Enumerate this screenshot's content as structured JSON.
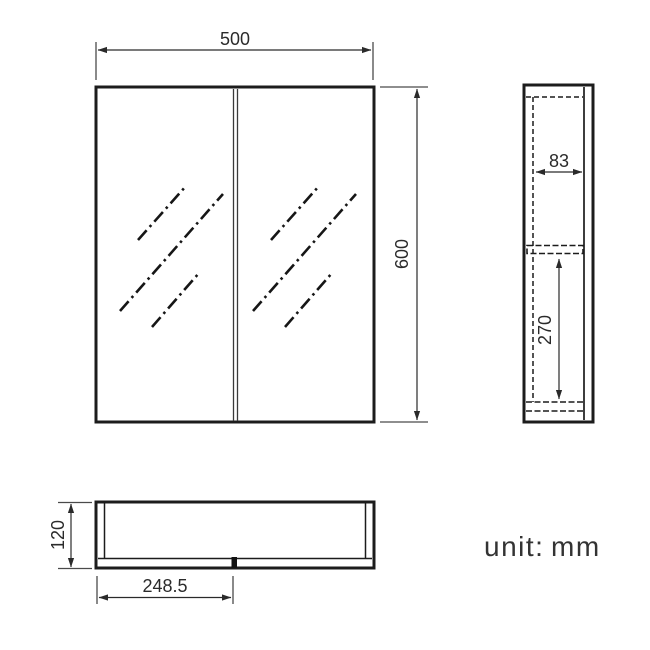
{
  "unit_note": {
    "label": "unit:",
    "value": "mm"
  },
  "dimensions": {
    "front_width": "500",
    "front_height": "600",
    "side_inner_depth": "83",
    "side_opening_height": "270",
    "bottom_depth": "120",
    "bottom_door_width": "248.5"
  },
  "colors": {
    "line": "#1c1c1c",
    "dim_line": "#3a3a3a",
    "background": "#ffffff"
  }
}
